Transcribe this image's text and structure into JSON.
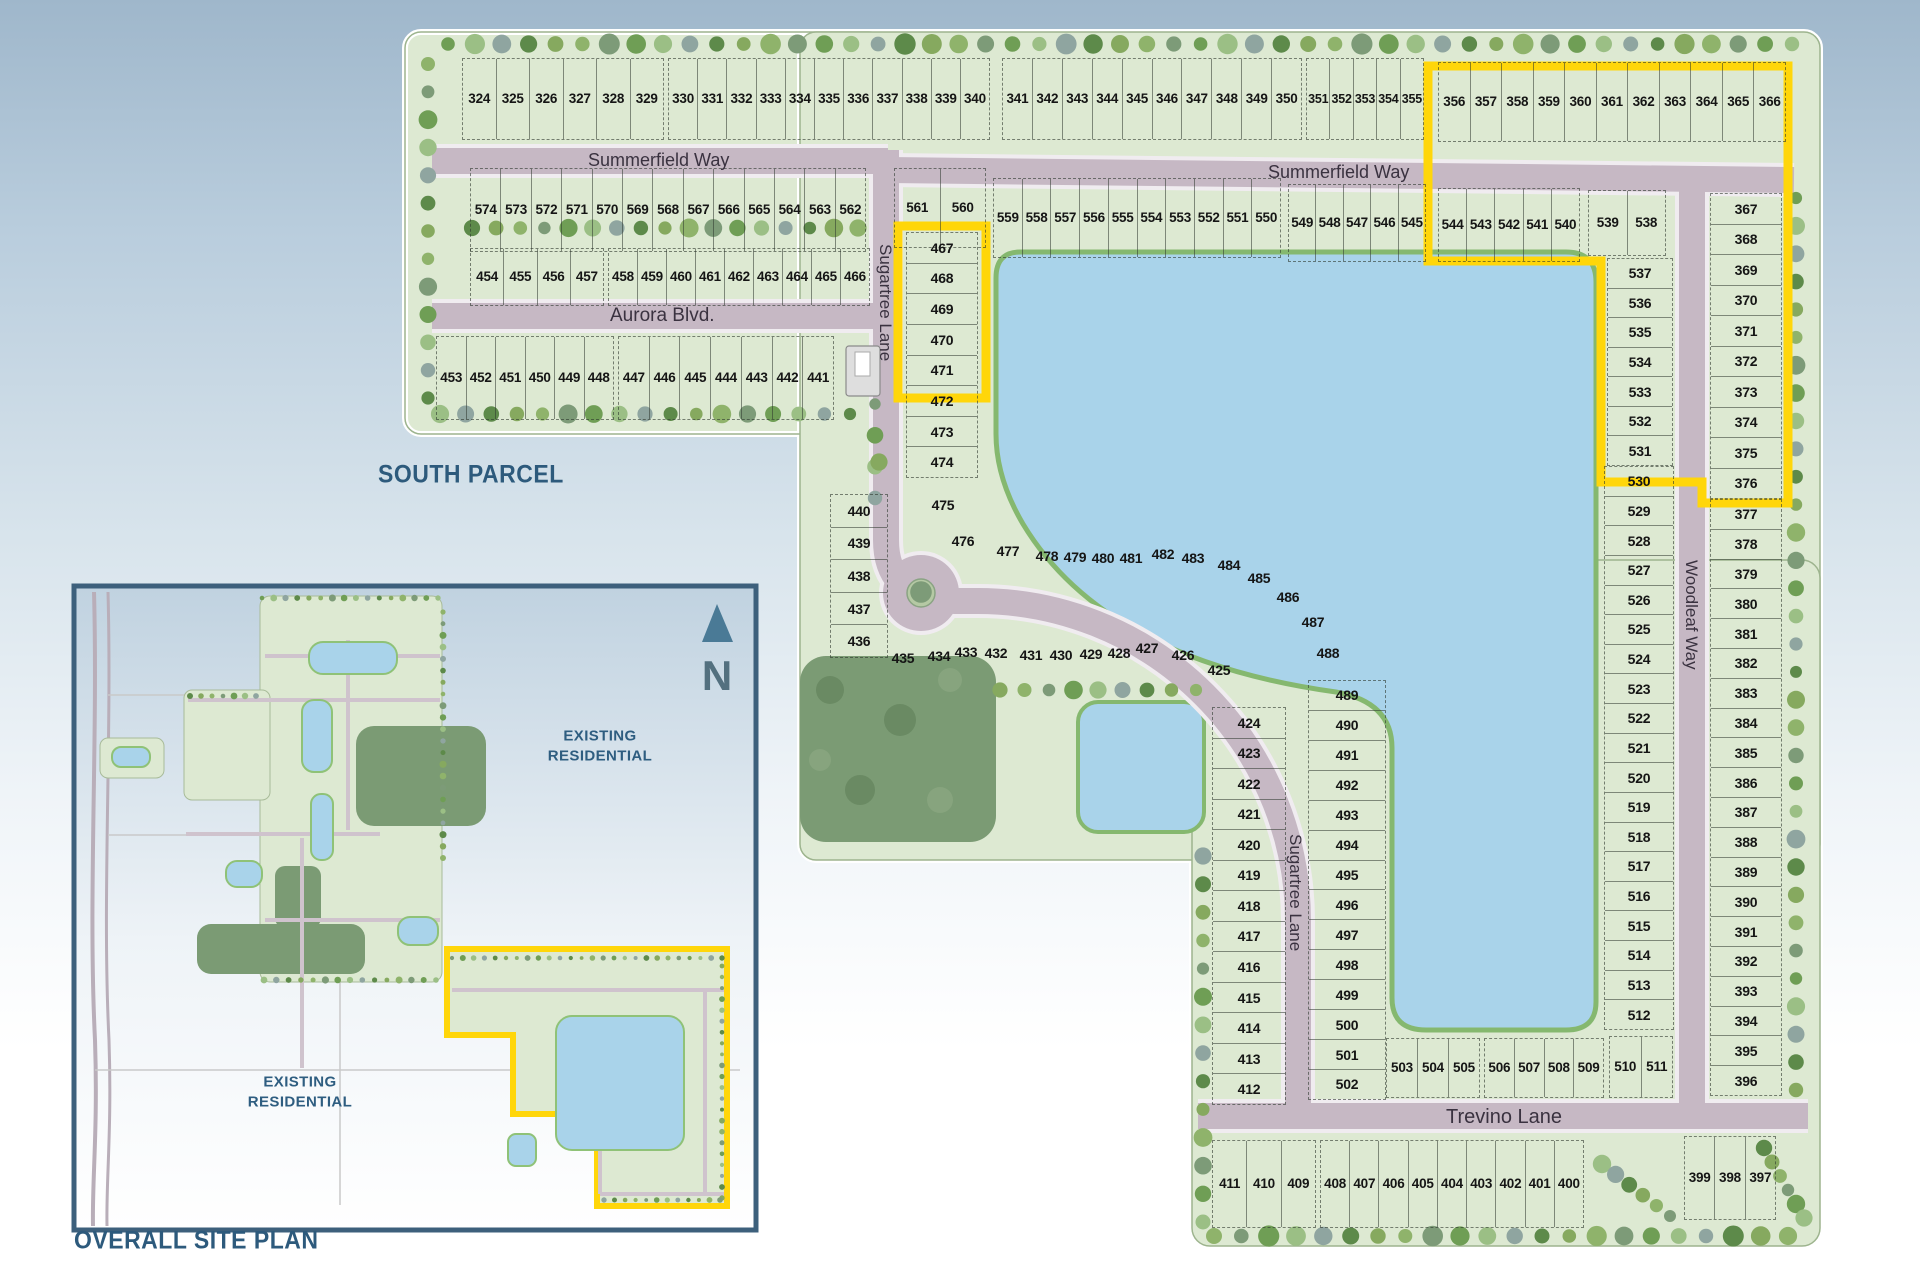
{
  "titles": {
    "south_parcel": "SOUTH PARCEL",
    "overall_site_plan": "OVERALL SITE PLAN"
  },
  "streets": {
    "summerfield": "Summerfield Way",
    "aurora": "Aurora Blvd.",
    "sugartree": "Sugartree Lane",
    "woodleaf": "Woodleaf Way",
    "trevino": "Trevino Lane"
  },
  "inset": {
    "existing_line1": "EXISTING",
    "existing_line2": "RESIDENTIAL",
    "north_label": "N"
  },
  "colors": {
    "highlight": "#ffd60a",
    "parcel": "#dde9d2",
    "lake": "#a9d3ea",
    "road": "#c6b8c4",
    "forest": "#7b9b74",
    "title": "#2d5a7c"
  },
  "lot_strips": [
    {
      "dir": "h",
      "x": 462,
      "y": 58,
      "w": 202,
      "h": 82,
      "lots": [
        "324",
        "325",
        "326",
        "327",
        "328",
        "329"
      ]
    },
    {
      "dir": "h",
      "x": 668,
      "y": 58,
      "w": 322,
      "h": 82,
      "lots": [
        "330",
        "331",
        "332",
        "333",
        "334",
        "335",
        "336",
        "337",
        "338",
        "339",
        "340"
      ]
    },
    {
      "dir": "h",
      "x": 1002,
      "y": 58,
      "w": 300,
      "h": 82,
      "lots": [
        "341",
        "342",
        "343",
        "344",
        "345",
        "346",
        "347",
        "348",
        "349",
        "350"
      ]
    },
    {
      "dir": "h",
      "x": 1306,
      "y": 58,
      "w": 118,
      "h": 82,
      "fs": 12.5,
      "lots": [
        "351",
        "352",
        "353",
        "354",
        "355"
      ]
    },
    {
      "dir": "h",
      "x": 1438,
      "y": 62,
      "w": 348,
      "h": 80,
      "lots": [
        "356",
        "357",
        "358",
        "359",
        "360",
        "361",
        "362",
        "363",
        "364",
        "365",
        "366"
      ]
    },
    {
      "dir": "h",
      "x": 470,
      "y": 168,
      "w": 396,
      "h": 84,
      "lots": [
        "574",
        "573",
        "572",
        "571",
        "570",
        "569",
        "568",
        "567",
        "566",
        "565",
        "564",
        "563",
        "562"
      ]
    },
    {
      "dir": "h",
      "x": 894,
      "y": 168,
      "w": 92,
      "h": 80,
      "lots": [
        "561",
        "560"
      ]
    },
    {
      "dir": "h",
      "x": 993,
      "y": 178,
      "w": 288,
      "h": 80,
      "lots": [
        "559",
        "558",
        "557",
        "556",
        "555",
        "554",
        "553",
        "552",
        "551",
        "550"
      ]
    },
    {
      "dir": "h",
      "x": 1288,
      "y": 184,
      "w": 138,
      "h": 78,
      "lots": [
        "549",
        "548",
        "547",
        "546",
        "545"
      ]
    },
    {
      "dir": "h",
      "x": 1438,
      "y": 188,
      "w": 142,
      "h": 74,
      "lots": [
        "544",
        "543",
        "542",
        "541",
        "540"
      ]
    },
    {
      "dir": "h",
      "x": 1588,
      "y": 190,
      "w": 78,
      "h": 66,
      "lots": [
        "539",
        "538"
      ]
    },
    {
      "dir": "h",
      "x": 470,
      "y": 248,
      "w": 134,
      "h": 58,
      "lots": [
        "454",
        "455",
        "456",
        "457"
      ]
    },
    {
      "dir": "h",
      "x": 608,
      "y": 248,
      "w": 262,
      "h": 58,
      "lots": [
        "458",
        "459",
        "460",
        "461",
        "462",
        "463",
        "464",
        "465",
        "466"
      ]
    },
    {
      "dir": "h",
      "x": 436,
      "y": 336,
      "w": 178,
      "h": 84,
      "lots": [
        "453",
        "452",
        "451",
        "450",
        "449",
        "448"
      ]
    },
    {
      "dir": "h",
      "x": 618,
      "y": 336,
      "w": 216,
      "h": 84,
      "lots": [
        "447",
        "446",
        "445",
        "444",
        "443",
        "442",
        "441"
      ]
    },
    {
      "dir": "v",
      "x": 906,
      "y": 232,
      "w": 72,
      "h": 246,
      "lots": [
        "467",
        "468",
        "469",
        "470",
        "471",
        "472",
        "473",
        "474"
      ]
    },
    {
      "dir": "v",
      "x": 830,
      "y": 494,
      "w": 58,
      "h": 164,
      "lots": [
        "440",
        "439",
        "438",
        "437",
        "436"
      ]
    },
    {
      "dir": "v",
      "x": 1212,
      "y": 707,
      "w": 74,
      "h": 398,
      "lots": [
        "424",
        "423",
        "422",
        "421",
        "420",
        "419",
        "418",
        "417",
        "416",
        "415",
        "414",
        "413",
        "412"
      ]
    },
    {
      "dir": "v",
      "x": 1308,
      "y": 680,
      "w": 78,
      "h": 420,
      "lots": [
        "489",
        "490",
        "491",
        "492",
        "493",
        "494",
        "495",
        "496",
        "497",
        "498",
        "499",
        "500",
        "501",
        "502"
      ]
    },
    {
      "dir": "h",
      "x": 1386,
      "y": 1038,
      "w": 94,
      "h": 60,
      "lots": [
        "503",
        "504",
        "505"
      ]
    },
    {
      "dir": "h",
      "x": 1484,
      "y": 1038,
      "w": 120,
      "h": 60,
      "lots": [
        "506",
        "507",
        "508",
        "509"
      ]
    },
    {
      "dir": "h",
      "x": 1609,
      "y": 1036,
      "w": 64,
      "h": 62,
      "lots": [
        "510",
        "511"
      ]
    },
    {
      "dir": "v",
      "x": 1607,
      "y": 258,
      "w": 66,
      "h": 208,
      "lots": [
        "537",
        "536",
        "535",
        "534",
        "533",
        "532",
        "531"
      ]
    },
    {
      "dir": "v",
      "x": 1604,
      "y": 466,
      "w": 70,
      "h": 564,
      "lots": [
        "530",
        "529",
        "528",
        "527",
        "526",
        "525",
        "524",
        "523",
        "522",
        "521",
        "520",
        "519",
        "518",
        "517",
        "516",
        "515",
        "514",
        "513",
        "512"
      ]
    },
    {
      "dir": "v",
      "x": 1710,
      "y": 193,
      "w": 72,
      "h": 306,
      "lots": [
        "367",
        "368",
        "369",
        "370",
        "371",
        "372",
        "373",
        "374",
        "375",
        "376"
      ]
    },
    {
      "dir": "v",
      "x": 1710,
      "y": 499,
      "w": 72,
      "h": 597,
      "lots": [
        "377",
        "378",
        "379",
        "380",
        "381",
        "382",
        "383",
        "384",
        "385",
        "386",
        "387",
        "388",
        "389",
        "390",
        "391",
        "392",
        "393",
        "394",
        "395",
        "396"
      ]
    },
    {
      "dir": "h",
      "x": 1212,
      "y": 1140,
      "w": 104,
      "h": 88,
      "lots": [
        "411",
        "410",
        "409"
      ]
    },
    {
      "dir": "h",
      "x": 1320,
      "y": 1140,
      "w": 264,
      "h": 88,
      "lots": [
        "408",
        "407",
        "406",
        "405",
        "404",
        "403",
        "402",
        "401",
        "400"
      ]
    },
    {
      "dir": "h",
      "x": 1684,
      "y": 1136,
      "w": 92,
      "h": 84,
      "lots": [
        "399",
        "398",
        "397"
      ]
    }
  ],
  "lot_points": [
    {
      "n": "475",
      "x": 943,
      "y": 505
    },
    {
      "n": "476",
      "x": 963,
      "y": 541
    },
    {
      "n": "477",
      "x": 1008,
      "y": 551
    },
    {
      "n": "478",
      "x": 1047,
      "y": 556
    },
    {
      "n": "479",
      "x": 1075,
      "y": 557
    },
    {
      "n": "480",
      "x": 1103,
      "y": 558
    },
    {
      "n": "481",
      "x": 1131,
      "y": 558
    },
    {
      "n": "482",
      "x": 1163,
      "y": 554
    },
    {
      "n": "483",
      "x": 1193,
      "y": 558
    },
    {
      "n": "484",
      "x": 1229,
      "y": 565
    },
    {
      "n": "485",
      "x": 1259,
      "y": 578
    },
    {
      "n": "486",
      "x": 1288,
      "y": 597
    },
    {
      "n": "487",
      "x": 1313,
      "y": 622
    },
    {
      "n": "488",
      "x": 1328,
      "y": 653
    },
    {
      "n": "435",
      "x": 903,
      "y": 658
    },
    {
      "n": "434",
      "x": 939,
      "y": 656
    },
    {
      "n": "433",
      "x": 966,
      "y": 652
    },
    {
      "n": "432",
      "x": 996,
      "y": 653
    },
    {
      "n": "431",
      "x": 1031,
      "y": 655
    },
    {
      "n": "430",
      "x": 1061,
      "y": 655
    },
    {
      "n": "429",
      "x": 1091,
      "y": 654
    },
    {
      "n": "428",
      "x": 1119,
      "y": 653
    },
    {
      "n": "427",
      "x": 1147,
      "y": 648
    },
    {
      "n": "426",
      "x": 1183,
      "y": 655
    },
    {
      "n": "425",
      "x": 1219,
      "y": 670
    }
  ]
}
